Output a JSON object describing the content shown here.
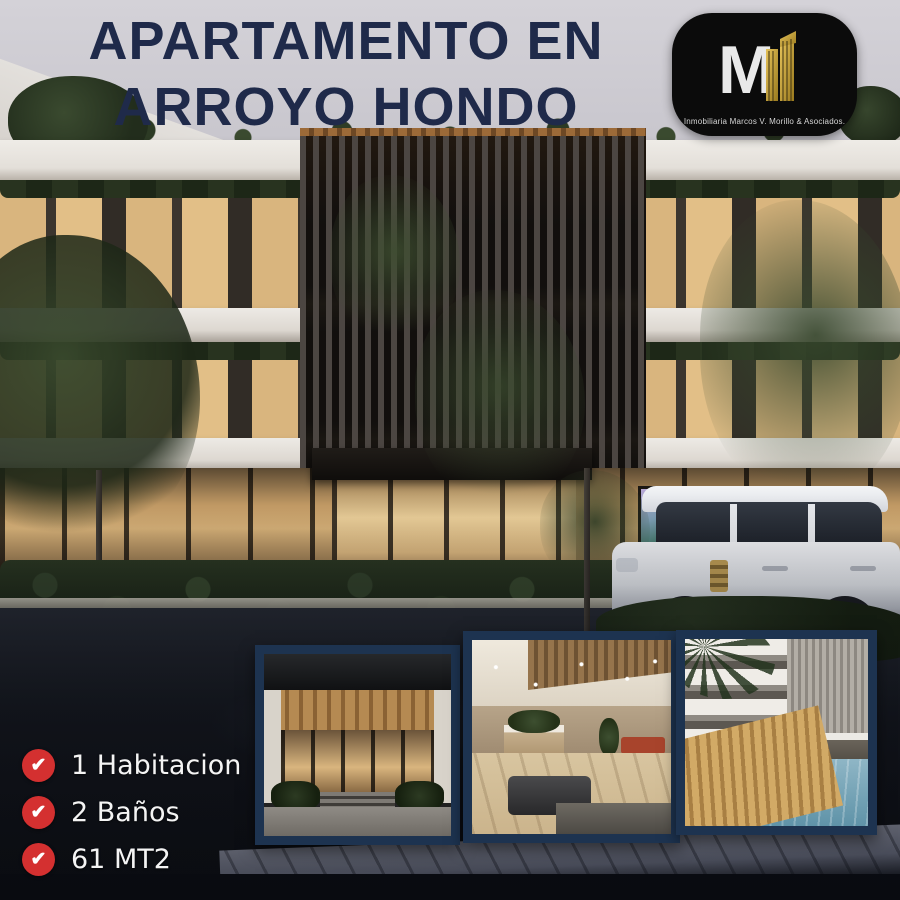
{
  "title": {
    "line1": "APARTAMENTO EN",
    "line2": "ARROYO HONDO"
  },
  "logo": {
    "monogram": "M",
    "caption": "Inmobiliaria Marcos V. Morillo & Asociados."
  },
  "features": [
    {
      "label": "1 Habitacion"
    },
    {
      "label": "2 Baños"
    },
    {
      "label": "61 MT2"
    }
  ],
  "gallery": [
    {
      "name": "entrance-photo"
    },
    {
      "name": "lobby-photo"
    },
    {
      "name": "pool-photo"
    }
  ],
  "icons": {
    "check": "✔"
  },
  "colors": {
    "title_navy": "#1f2a4a",
    "frame_navy": "#1d3350",
    "check_red": "#d43030",
    "logo_black": "#0b0b0b",
    "logo_gold": "#c9a227",
    "feature_text": "#f4f4f4",
    "sky": "#c9c7ce"
  }
}
